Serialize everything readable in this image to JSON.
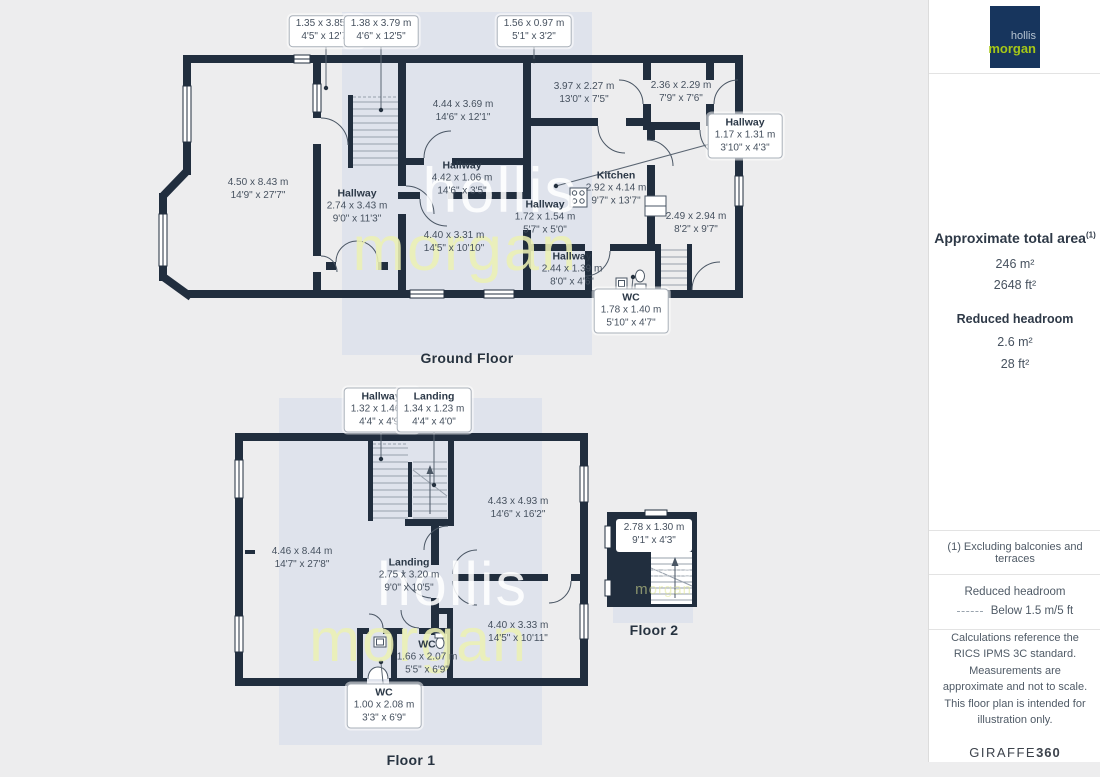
{
  "colors": {
    "wall": "#212e3e",
    "backdrop_panel": "#dfe3ec",
    "page_background": "#ededee",
    "logo_background": "#17355d",
    "logo_hollis": "#b6c4d1",
    "logo_morgan": "#a6c717",
    "watermark_hollis": "#ffffff",
    "watermark_morgan": "#ecf0b4"
  },
  "branding": {
    "line1": "hollis",
    "line2": "morgan"
  },
  "watermark": {
    "line1": "hollis",
    "line2": "morgan"
  },
  "sidebar": {
    "total_area_heading": "Approximate total area",
    "total_area_footnote": "(1)",
    "total_area_metric": "246 m²",
    "total_area_imperial": "2648 ft²",
    "reduced_heading": "Reduced headroom",
    "reduced_metric": "2.6 m²",
    "reduced_imperial": "28 ft²",
    "footnote": "(1) Excluding balconies and terraces",
    "legend_title": "Reduced headroom",
    "legend_value": "Below 1.5 m/5 ft",
    "disclaimer": "Calculations reference the RICS IPMS 3C standard. Measurements are approximate and not to scale. This floor plan is intended for illustration only.",
    "brand": {
      "giraffe": "GIRAFFE",
      "threesixty": "360"
    }
  },
  "ground_floor": {
    "title": "Ground Floor",
    "labels": {
      "dim1": {
        "metric": "1.35 x 3.85 m",
        "imperial": "4'5\" x 12'7\""
      },
      "dim2": {
        "metric": "1.38 x 3.79 m",
        "imperial": "4'6\" x 12'5\""
      },
      "dim3": {
        "metric": "1.56 x 0.97 m",
        "imperial": "5'1\" x 3'2\""
      },
      "room_main": {
        "metric": "4.50 x 8.43 m",
        "imperial": "14'9\" x 27'7\""
      },
      "room_mid_top": {
        "metric": "4.44 x 3.69 m",
        "imperial": "14'6\" x 12'1\""
      },
      "hallway_wide": {
        "name": "Hallway",
        "metric": "4.42 x 1.06 m",
        "imperial": "14'6\" x 3'5\""
      },
      "hallway_main": {
        "name": "Hallway",
        "metric": "2.74 x 3.43 m",
        "imperial": "9'0\" x 11'3\""
      },
      "room_top_right": {
        "metric": "3.97 x 2.27 m",
        "imperial": "13'0\" x 7'5\""
      },
      "room_rear": {
        "metric": "2.36 x 2.29 m",
        "imperial": "7'9\" x 7'6\""
      },
      "hallway_box": {
        "name": "Hallway",
        "metric": "1.17 x 1.31 m",
        "imperial": "3'10\" x 4'3\""
      },
      "kitchen": {
        "name": "Kitchen",
        "metric": "2.92 x 4.14 m",
        "imperial": "9'7\" x 13'7\""
      },
      "hallway_small": {
        "name": "Hallway",
        "metric": "1.72 x 1.54 m",
        "imperial": "5'7\" x 5'0\""
      },
      "room_mid_bottom": {
        "metric": "4.40 x 3.31 m",
        "imperial": "14'5\" x 10'10\""
      },
      "room_right": {
        "metric": "2.49 x 2.94 m",
        "imperial": "8'2\" x 9'7\""
      },
      "hallway_rear": {
        "name": "Hallway",
        "metric": "2.44 x 1.39 m",
        "imperial": "8'0\" x 4'6\""
      },
      "wc_box": {
        "name": "WC",
        "metric": "1.78 x 1.40 m",
        "imperial": "5'10\" x 4'7\""
      }
    }
  },
  "floor1": {
    "title": "Floor 1",
    "labels": {
      "hallway_box": {
        "name": "Hallway",
        "metric": "1.32 x 1.46 m",
        "imperial": "4'4\" x 4'9\""
      },
      "landing_box": {
        "name": "Landing",
        "metric": "1.34 x 1.23 m",
        "imperial": "4'4\" x 4'0\""
      },
      "room_main": {
        "metric": "4.46 x 8.44 m",
        "imperial": "14'7\" x 27'8\""
      },
      "room_top_right": {
        "metric": "4.43 x 4.93 m",
        "imperial": "14'6\" x 16'2\""
      },
      "landing": {
        "name": "Landing",
        "metric": "2.75 x 3.20 m",
        "imperial": "9'0\" x 10'5\""
      },
      "room_bottom_right": {
        "metric": "4.40 x 3.33 m",
        "imperial": "14'5\" x 10'11\""
      },
      "wc": {
        "name": "WC",
        "metric": "1.66 x 2.07 m",
        "imperial": "5'5\" x 6'9\""
      },
      "wc_box": {
        "name": "WC",
        "metric": "1.00 x 2.08 m",
        "imperial": "3'3\" x 6'9\""
      }
    }
  },
  "floor2": {
    "title": "Floor 2",
    "labels": {
      "room": {
        "metric": "2.78 x 1.30 m",
        "imperial": "9'1\" x 4'3\""
      }
    }
  }
}
